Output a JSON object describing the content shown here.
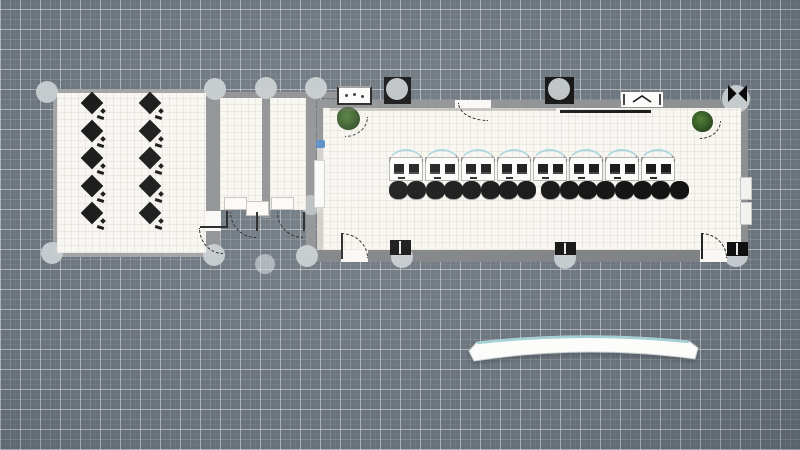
{
  "app": {
    "description": "2D floor-plan editor canvas, top-down view, no visible text"
  },
  "inventory": {
    "rooms": 4,
    "office_desks": 10,
    "hall_workstations": 8,
    "hall_chairs": 16,
    "potted_plants": 2,
    "doors_with_swing_arcs": 6,
    "selection_handles": 15,
    "radiators": 2,
    "reception_counters": 1
  },
  "scene": {
    "colors": {
      "canvas_bg": "#68717a",
      "grid_bright": "#aeb6bb",
      "floor": "#f8f6f1",
      "wall": "#8b8d8f",
      "wall_light": "#9ea0a2",
      "wall_dark": "#7c7f82",
      "shade": "#cfccc7",
      "handle": "#c7ccd0",
      "handle_soft": "#dde1e3",
      "ink": "#121212",
      "teal": "#a6d6da",
      "plant_green": "#2f5220",
      "blue_item": "#4d86c4",
      "white": "#fcfcfb",
      "desk_border": "#b3b1ae"
    },
    "walls": [
      {
        "x": 53,
        "y": 89,
        "w": 157,
        "h": 4,
        "c": "wall_light",
        "name": "office-wall-top"
      },
      {
        "x": 53,
        "y": 89,
        "w": 4,
        "h": 168,
        "c": "wall_light",
        "name": "office-wall-left"
      },
      {
        "x": 53,
        "y": 253,
        "w": 157,
        "h": 4,
        "c": "wall_light",
        "name": "office-wall-bottom"
      },
      {
        "x": 206,
        "y": 89,
        "w": 14,
        "h": 168,
        "c": "wall",
        "name": "office-closet-divider-wall"
      },
      {
        "x": 206,
        "y": 92,
        "w": 146,
        "h": 6,
        "c": "wall",
        "name": "closet-top-wall"
      },
      {
        "x": 262,
        "y": 95,
        "w": 8,
        "h": 123,
        "c": "wall",
        "name": "closet-divider-wall"
      },
      {
        "x": 306,
        "y": 95,
        "w": 10,
        "h": 163,
        "c": "wall",
        "name": "closet-right-wall"
      },
      {
        "x": 317,
        "y": 100,
        "w": 431,
        "h": 8,
        "c": "wall",
        "name": "hall-wall-top"
      },
      {
        "x": 741,
        "y": 100,
        "w": 7,
        "h": 162,
        "c": "wall",
        "name": "hall-wall-right"
      },
      {
        "x": 317,
        "y": 250,
        "w": 431,
        "h": 12,
        "c": "wall_dark",
        "name": "hall-wall-bottom"
      },
      {
        "x": 317,
        "y": 100,
        "w": 6,
        "h": 45,
        "c": "wall",
        "name": "hall-wall-left"
      },
      {
        "x": 317,
        "y": 145,
        "w": 12,
        "h": 105,
        "c": "shade",
        "name": "hall-left-column"
      }
    ],
    "floors": [
      {
        "x": 57,
        "y": 93,
        "w": 149,
        "h": 160,
        "name": "office-room-floor"
      },
      {
        "x": 220,
        "y": 98,
        "w": 42,
        "h": 112,
        "name": "closet-a-floor"
      },
      {
        "x": 270,
        "y": 98,
        "w": 36,
        "h": 112,
        "name": "closet-b-floor"
      },
      {
        "x": 323,
        "y": 108,
        "w": 418,
        "h": 142,
        "name": "hall-room-floor"
      }
    ],
    "wall_gaps": [
      {
        "x": 341,
        "y": 250,
        "w": 27,
        "h": 12,
        "name": "hall-door-gap-left"
      },
      {
        "x": 700,
        "y": 250,
        "w": 27,
        "h": 12,
        "name": "hall-door-gap-right"
      },
      {
        "x": 455,
        "y": 100,
        "w": 36,
        "h": 8,
        "name": "hall-door-gap-top"
      },
      {
        "x": 205,
        "y": 211,
        "w": 16,
        "h": 20,
        "name": "office-door-gap"
      }
    ],
    "handles": [
      {
        "cx": 47,
        "cy": 92,
        "r": 11
      },
      {
        "cx": 215,
        "cy": 89,
        "r": 11
      },
      {
        "cx": 266,
        "cy": 88,
        "r": 11
      },
      {
        "cx": 316,
        "cy": 88,
        "r": 11
      },
      {
        "cx": 52,
        "cy": 253,
        "r": 11
      },
      {
        "cx": 214,
        "cy": 255,
        "r": 11
      },
      {
        "cx": 307,
        "cy": 256,
        "r": 11
      },
      {
        "cx": 265,
        "cy": 264,
        "r": 10,
        "mode": "soft"
      },
      {
        "cx": 311,
        "cy": 205,
        "r": 10,
        "mode": "soft"
      },
      {
        "cx": 397,
        "cy": 89,
        "r": 11,
        "mode": "over"
      },
      {
        "cx": 559,
        "cy": 89,
        "r": 11,
        "mode": "over"
      },
      {
        "cx": 736,
        "cy": 99,
        "r": 14
      },
      {
        "cx": 736,
        "cy": 255,
        "r": 12
      },
      {
        "cx": 402,
        "cy": 257,
        "r": 11
      },
      {
        "cx": 565,
        "cy": 258,
        "r": 11
      }
    ],
    "office_desks": {
      "cols_x": [
        92,
        150
      ],
      "rows_y": [
        103,
        131,
        158,
        186,
        213
      ],
      "size": 16
    },
    "workstation_row": {
      "x": 389,
      "y": 151,
      "unit_w": 36,
      "count": 8
    },
    "chair_row": {
      "x": 389,
      "y": 181,
      "d": 19,
      "count": 16,
      "mid_gap": 6
    },
    "furniture": [
      {
        "type": "console-table",
        "name": "console-table",
        "x": 337,
        "y": 86,
        "w": 35,
        "h": 19
      },
      {
        "type": "black-box",
        "name": "wall-fixture",
        "x": 384,
        "y": 77,
        "w": 27,
        "h": 27
      },
      {
        "type": "black-box",
        "name": "wall-fixture",
        "x": 545,
        "y": 77,
        "w": 29,
        "h": 27
      },
      {
        "type": "window",
        "name": "window",
        "x": 621,
        "y": 92,
        "w": 42,
        "h": 15
      },
      {
        "type": "bowtie",
        "name": "corner-window",
        "x": 727,
        "y": 84,
        "w": 21,
        "h": 19
      },
      {
        "type": "black-box-slit",
        "name": "wall-fixture",
        "x": 727,
        "y": 242,
        "w": 21,
        "h": 14
      },
      {
        "type": "black-box-slit",
        "name": "wall-fixture",
        "x": 390,
        "y": 240,
        "w": 21,
        "h": 15
      },
      {
        "type": "black-box-slit",
        "name": "wall-fixture",
        "x": 555,
        "y": 242,
        "w": 21,
        "h": 13
      },
      {
        "type": "radiator",
        "name": "radiator",
        "x": 740,
        "y": 177,
        "w": 12,
        "h": 23
      },
      {
        "type": "radiator",
        "name": "radiator",
        "x": 740,
        "y": 202,
        "w": 12,
        "h": 23
      },
      {
        "type": "plant",
        "name": "potted-plant",
        "x": 337,
        "y": 107,
        "d": 23
      },
      {
        "type": "plant",
        "name": "potted-plant",
        "x": 692,
        "y": 111,
        "d": 21
      },
      {
        "type": "blue-item",
        "name": "wall-decor",
        "x": 316,
        "y": 140,
        "w": 9,
        "h": 8
      },
      {
        "type": "shelf",
        "name": "wall-shelf",
        "x": 314,
        "y": 160,
        "w": 11,
        "h": 48
      },
      {
        "type": "closet-table",
        "name": "closet-table",
        "x": 224,
        "y": 197,
        "w": 23,
        "h": 13
      },
      {
        "type": "closet-table",
        "name": "closet-table",
        "x": 246,
        "y": 201,
        "w": 23,
        "h": 15
      },
      {
        "type": "closet-table",
        "name": "closet-table",
        "x": 271,
        "y": 197,
        "w": 23,
        "h": 13
      },
      {
        "type": "board-line",
        "name": "wall-board",
        "x": 560,
        "y": 110,
        "w": 91,
        "h": 3
      },
      {
        "type": "wall-shade",
        "name": "wall-shadow",
        "x": 330,
        "y": 108,
        "w": 226,
        "h": 3
      }
    ],
    "doors": [
      {
        "name": "hall-door-left",
        "leaf": [
          341,
          233,
          2,
          26
        ],
        "arc": {
          "x": 341,
          "y": 233,
          "w": 27,
          "h": 25,
          "corner": "tr"
        }
      },
      {
        "name": "hall-door-right",
        "leaf": [
          701,
          233,
          2,
          26
        ],
        "arc": {
          "x": 701,
          "y": 233,
          "w": 26,
          "h": 25,
          "corner": "tr"
        }
      },
      {
        "name": "closet-a-door",
        "leaf": [
          256,
          212,
          2,
          19
        ],
        "arc": {
          "x": 230,
          "y": 212,
          "w": 26,
          "h": 26,
          "corner": "bl"
        }
      },
      {
        "name": "closet-b-door",
        "leaf": [
          303,
          212,
          2,
          19
        ],
        "arc": {
          "x": 277,
          "y": 212,
          "w": 26,
          "h": 26,
          "corner": "bl"
        }
      },
      {
        "name": "office-door",
        "leaf": [
          226,
          211,
          2,
          17
        ],
        "leaf2": [
          200,
          226,
          27,
          2
        ],
        "arc": {
          "x": 199,
          "y": 228,
          "w": 24,
          "h": 26,
          "corner": "bl"
        }
      },
      {
        "name": "hall-top-door",
        "arc": {
          "x": 458,
          "y": 103,
          "w": 30,
          "h": 18,
          "corner": "bl"
        }
      }
    ],
    "reception_desk": {
      "x": 455,
      "y": 330,
      "w": 255,
      "h": 42,
      "path_body": "M14,21 L22,12 Q128,0 234,11 L243,18 L240,29 Q128,14 19,31 Z",
      "path_top": "M22,13 Q128,1 234,12"
    }
  }
}
